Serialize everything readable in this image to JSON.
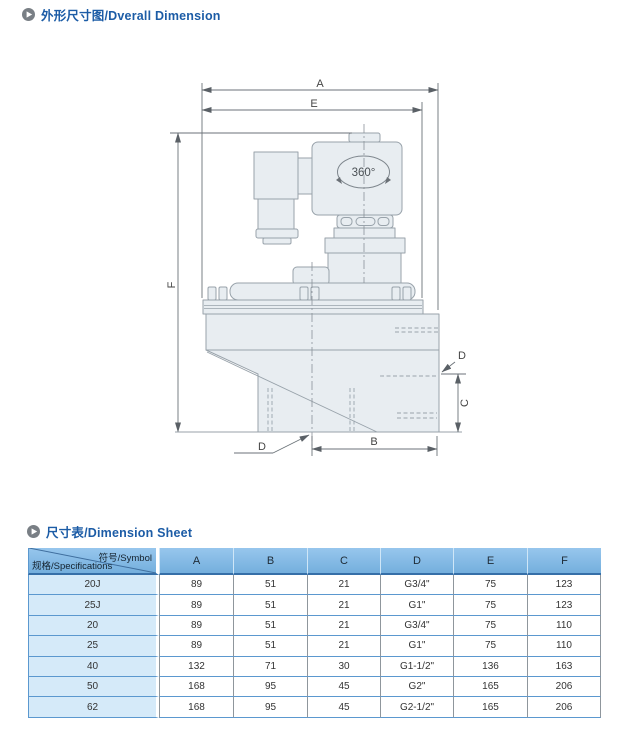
{
  "sections": {
    "overall_dimension": {
      "title": "外形尺寸图/Dverall Dimension"
    },
    "dimension_sheet": {
      "title": "尺寸表/Dimension Sheet"
    }
  },
  "drawing": {
    "labels": {
      "a": "A",
      "e": "E",
      "f": "F",
      "b": "B",
      "c": "C",
      "d_right": "D",
      "d_bottom": "D",
      "rotation": "360°"
    }
  },
  "table": {
    "corner": {
      "top_right": "符号/Symbol",
      "bottom_left": "规格/Specifications"
    },
    "columns": [
      "A",
      "B",
      "C",
      "D",
      "E",
      "F"
    ],
    "rows": [
      {
        "spec": "20J",
        "values": [
          "89",
          "51",
          "21",
          "G3/4\"",
          "75",
          "123"
        ]
      },
      {
        "spec": "25J",
        "values": [
          "89",
          "51",
          "21",
          "G1\"",
          "75",
          "123"
        ]
      },
      {
        "spec": "20",
        "values": [
          "89",
          "51",
          "21",
          "G3/4\"",
          "75",
          "110"
        ]
      },
      {
        "spec": "25",
        "values": [
          "89",
          "51",
          "21",
          "G1\"",
          "75",
          "110"
        ]
      },
      {
        "spec": "40",
        "values": [
          "132",
          "71",
          "30",
          "G1-1/2\"",
          "136",
          "163"
        ]
      },
      {
        "spec": "50",
        "values": [
          "168",
          "95",
          "45",
          "G2\"",
          "165",
          "206"
        ]
      },
      {
        "spec": "62",
        "values": [
          "168",
          "95",
          "45",
          "G2-1/2\"",
          "165",
          "206"
        ]
      }
    ]
  },
  "colors": {
    "title_blue": "#1c5ca6",
    "header_blue": "#7db6e2",
    "spec_cell_blue": "#d5eaf9",
    "row_border_blue": "#5b98cf",
    "drawing_fill": "#e8edf1",
    "drawing_stroke": "#98a2aa"
  }
}
